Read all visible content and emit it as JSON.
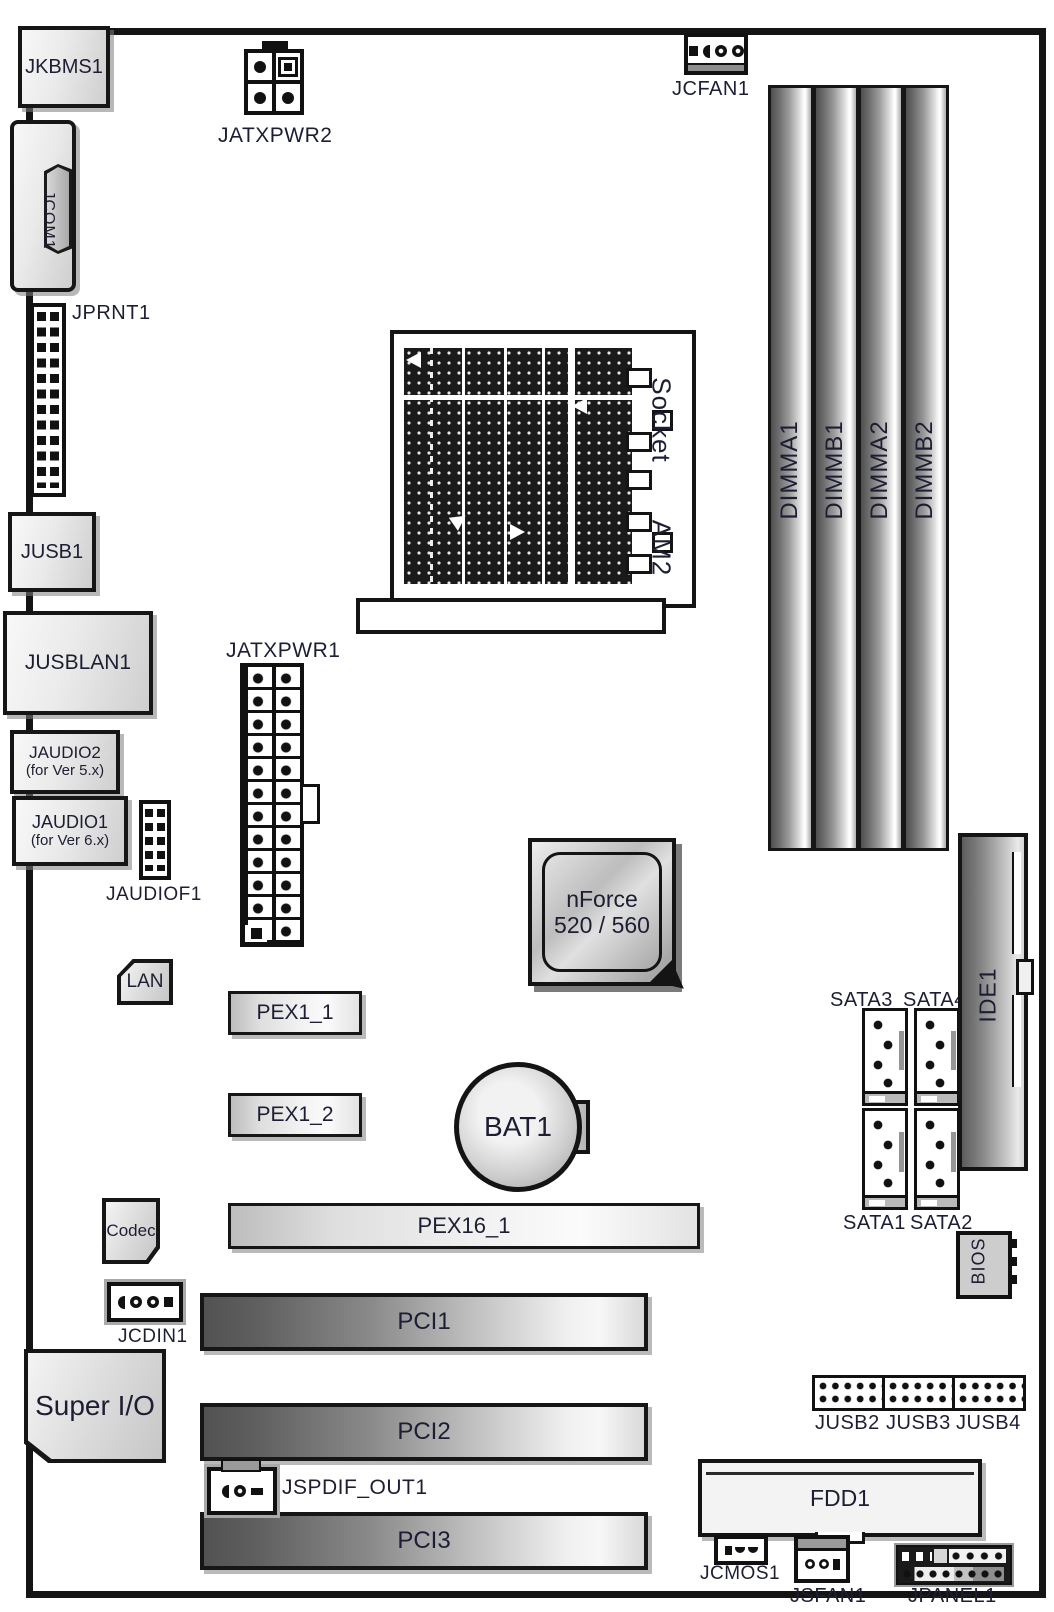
{
  "colors": {
    "board_border": "#141414",
    "label_text": "#1d1e33",
    "slot_dark": "#525252",
    "slot_light": "#f2f2f2",
    "shadow": "#9a9a9a"
  },
  "back_panel": {
    "jkbms1": "JKBMS1",
    "jcom1": "JCOM1",
    "jprnt1": "JPRNT1",
    "jusb1": "JUSB1",
    "jusblan1": "JUSBLAN1",
    "jaudio2_line1": "JAUDIO2",
    "jaudio2_line2": "(for Ver 5.x)",
    "jaudio1_line1": "JAUDIO1",
    "jaudio1_line2": "(for Ver 6.x)"
  },
  "headers": {
    "jaudiof1": "JAUDIOF1",
    "jcdin1": "JCDIN1",
    "jspdif_out1": "JSPDIF_OUT1",
    "jcfan1": "JCFAN1",
    "jsfan1": "JSFAN1",
    "jcmos1": "JCMOS1",
    "jpanel1": "JPANEL1",
    "jusb2": "JUSB2",
    "jusb3": "JUSB3",
    "jusb4": "JUSB4"
  },
  "chips": {
    "lan": "LAN",
    "codec": "Codec",
    "super_io": "Super I/O",
    "bios": "BIOS",
    "nforce_line1": "nForce",
    "nforce_line2": "520 / 560",
    "bat1": "BAT1"
  },
  "power": {
    "jatxpwr1": "JATXPWR1",
    "jatxpwr2": "JATXPWR2"
  },
  "cpu": {
    "socket_line1": "Socket",
    "socket_line2": "AM2"
  },
  "memory": {
    "dimm_slots": [
      "DIMMA1",
      "DIMMB1",
      "DIMMA2",
      "DIMMB2"
    ]
  },
  "expansion": {
    "pex1_1": "PEX1_1",
    "pex1_2": "PEX1_2",
    "pex16_1": "PEX16_1",
    "pci1": "PCI1",
    "pci2": "PCI2",
    "pci3": "PCI3"
  },
  "storage": {
    "ide1": "IDE1",
    "fdd1": "FDD1",
    "sata1": "SATA1",
    "sata2": "SATA2",
    "sata3": "SATA3",
    "sata4": "SATA4"
  }
}
